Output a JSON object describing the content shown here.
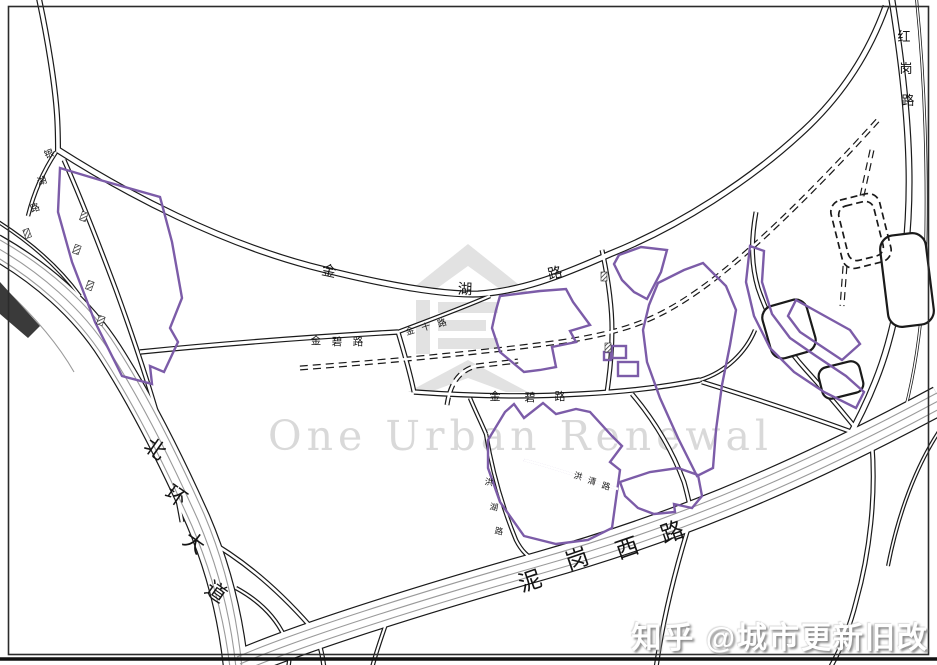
{
  "watermark": {
    "logo": "house-building-icon",
    "brand_text": "One Urban Renewal"
  },
  "credit": {
    "source_text": "知乎 @城市更新旧改"
  },
  "roads": {
    "beihuan": {
      "name": "北环大道",
      "chars": [
        "北",
        "环",
        "大",
        "道"
      ]
    },
    "nigang_west": {
      "name": "泥岗西路",
      "chars": [
        "泥",
        "岗",
        "西",
        "路"
      ]
    },
    "jinhu": {
      "name": "金湖路",
      "chars": [
        "金",
        "湖",
        "路"
      ]
    },
    "jinbi_west": {
      "name": "金碧路",
      "chars": [
        "金",
        "碧",
        "路"
      ]
    },
    "jinbi_east": {
      "name": "金碧路",
      "chars": [
        "金",
        "碧",
        "路"
      ]
    },
    "jinshi": {
      "name": "金十路",
      "chars": [
        "金",
        "十",
        "路"
      ]
    },
    "honggang": {
      "name": "红岗路",
      "chars": [
        "红",
        "岗",
        "路"
      ]
    },
    "yinhu": {
      "name": "银湖路",
      "chars": [
        "银",
        "湖",
        "路"
      ]
    },
    "hongqing": {
      "name": "洪清路",
      "chars": [
        "洪",
        "清",
        "路"
      ]
    },
    "honghu": {
      "name": "洪湖路",
      "chars": [
        "洪",
        "湖",
        "路"
      ]
    }
  },
  "colors": {
    "parcel_outline": "#7c5ca8",
    "road_line": "#1a1a1a",
    "lane_line": "#9a9a9a",
    "watermark_gray": "#e2e2e2"
  }
}
